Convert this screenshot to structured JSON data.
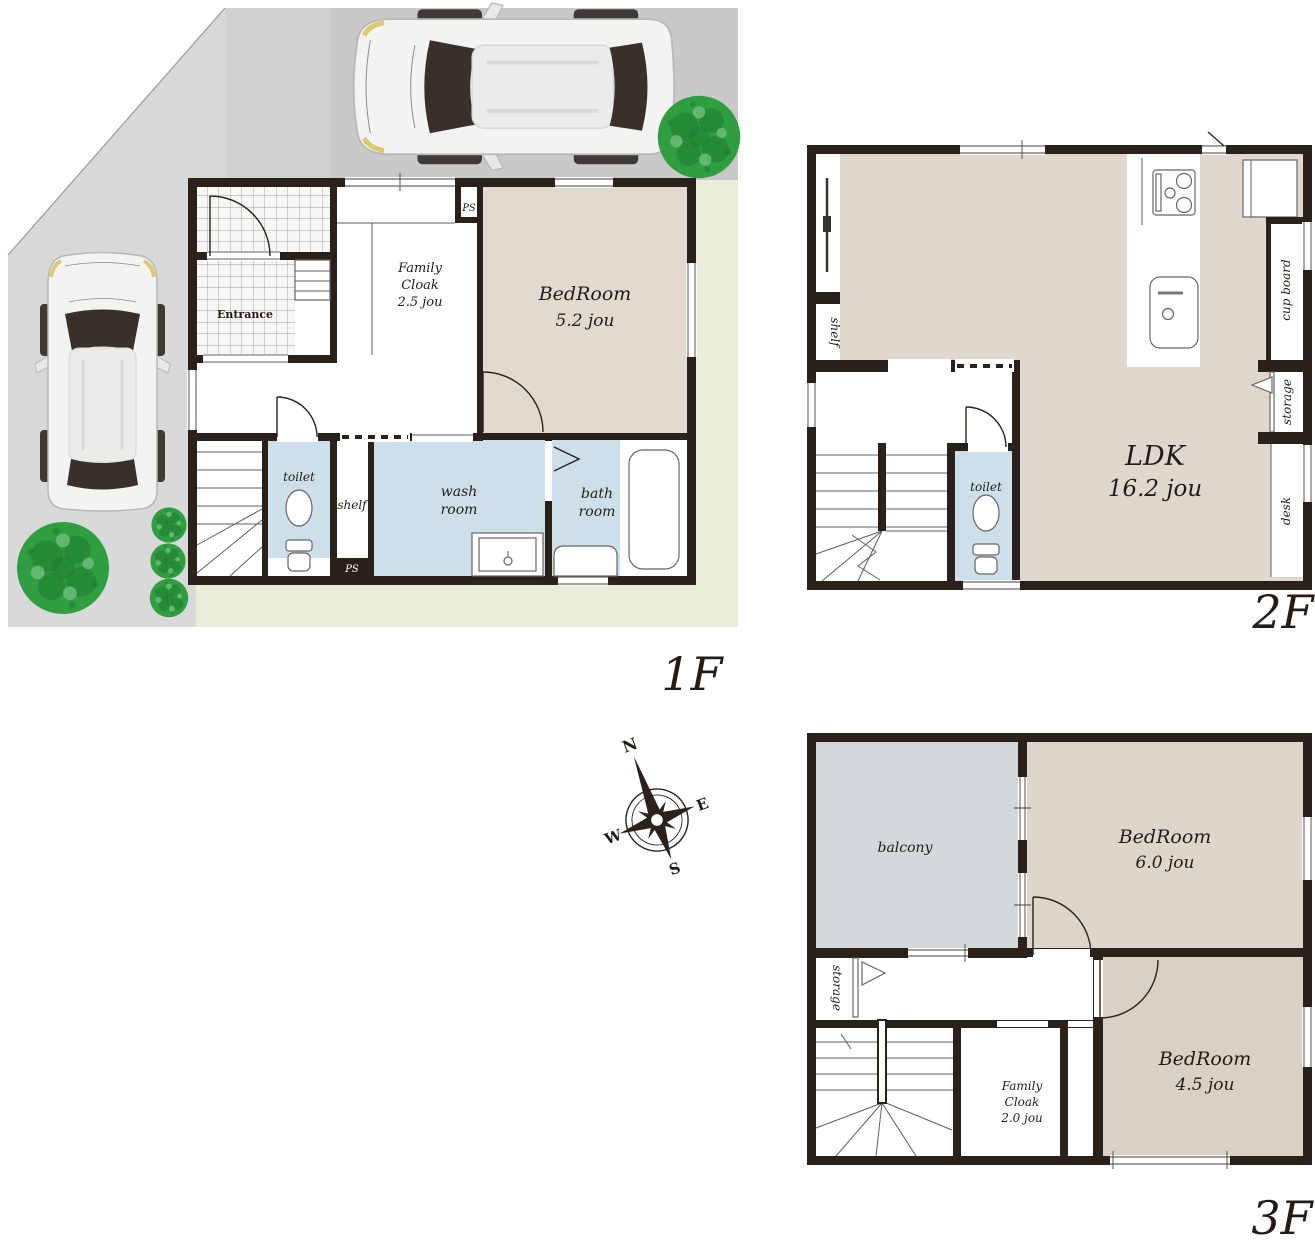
{
  "floor1": {
    "floor_label": "1F",
    "rooms": {
      "entrance": {
        "label": "Entrance"
      },
      "family_cloak": {
        "label": "Family",
        "label2": "Cloak",
        "size": "2.5 jou"
      },
      "bedroom": {
        "label": "BedRoom",
        "size": "5.2 jou"
      },
      "toilet": {
        "label": "toilet"
      },
      "shelf": {
        "label": "shelf"
      },
      "wash_room": {
        "label": "wash",
        "label2": "room"
      },
      "bath_room": {
        "label": "bath",
        "label2": "room"
      },
      "ps_top": {
        "label": "PS"
      },
      "ps_bottom": {
        "label": "PS"
      }
    }
  },
  "floor2": {
    "floor_label": "2F",
    "rooms": {
      "ldk": {
        "label": "LDK",
        "size": "16.2 jou"
      },
      "shelf": {
        "label": "shelf"
      },
      "toilet": {
        "label": "toilet"
      },
      "cup_board": {
        "label": "cup board"
      },
      "storage": {
        "label": "storage"
      },
      "desk": {
        "label": "desk"
      }
    }
  },
  "floor3": {
    "floor_label": "3F",
    "rooms": {
      "balcony": {
        "label": "balcony"
      },
      "bedroom_6": {
        "label": "BedRoom",
        "size": "6.0 jou"
      },
      "bedroom_45": {
        "label": "BedRoom",
        "size": "4.5 jou"
      },
      "storage": {
        "label": "storage"
      },
      "family_cloak": {
        "label": "Family",
        "label2": "Cloak",
        "size": "2.0 jou"
      }
    }
  },
  "compass": {
    "n": "N",
    "e": "E",
    "s": "S",
    "w": "W"
  },
  "colors": {
    "wall": "#2b211b",
    "text_dark": "#231c16",
    "bedroom_beige": "#e2d9d0",
    "ldk_beige": "#e0d7ce",
    "bedroom6_beige": "#ded6cc",
    "bedroom45_beige": "#d8d1c6",
    "wet_blue": "#cde0e9",
    "balcony_gray": "#d3d8da",
    "site_light": "#d9d9d9",
    "site_mid": "#d1d1d1",
    "site_dark": "#c9c9c9",
    "lawn_green": "#e9edda",
    "tree_green": "#2f9e41",
    "tree_dark": "#1f7c31"
  }
}
